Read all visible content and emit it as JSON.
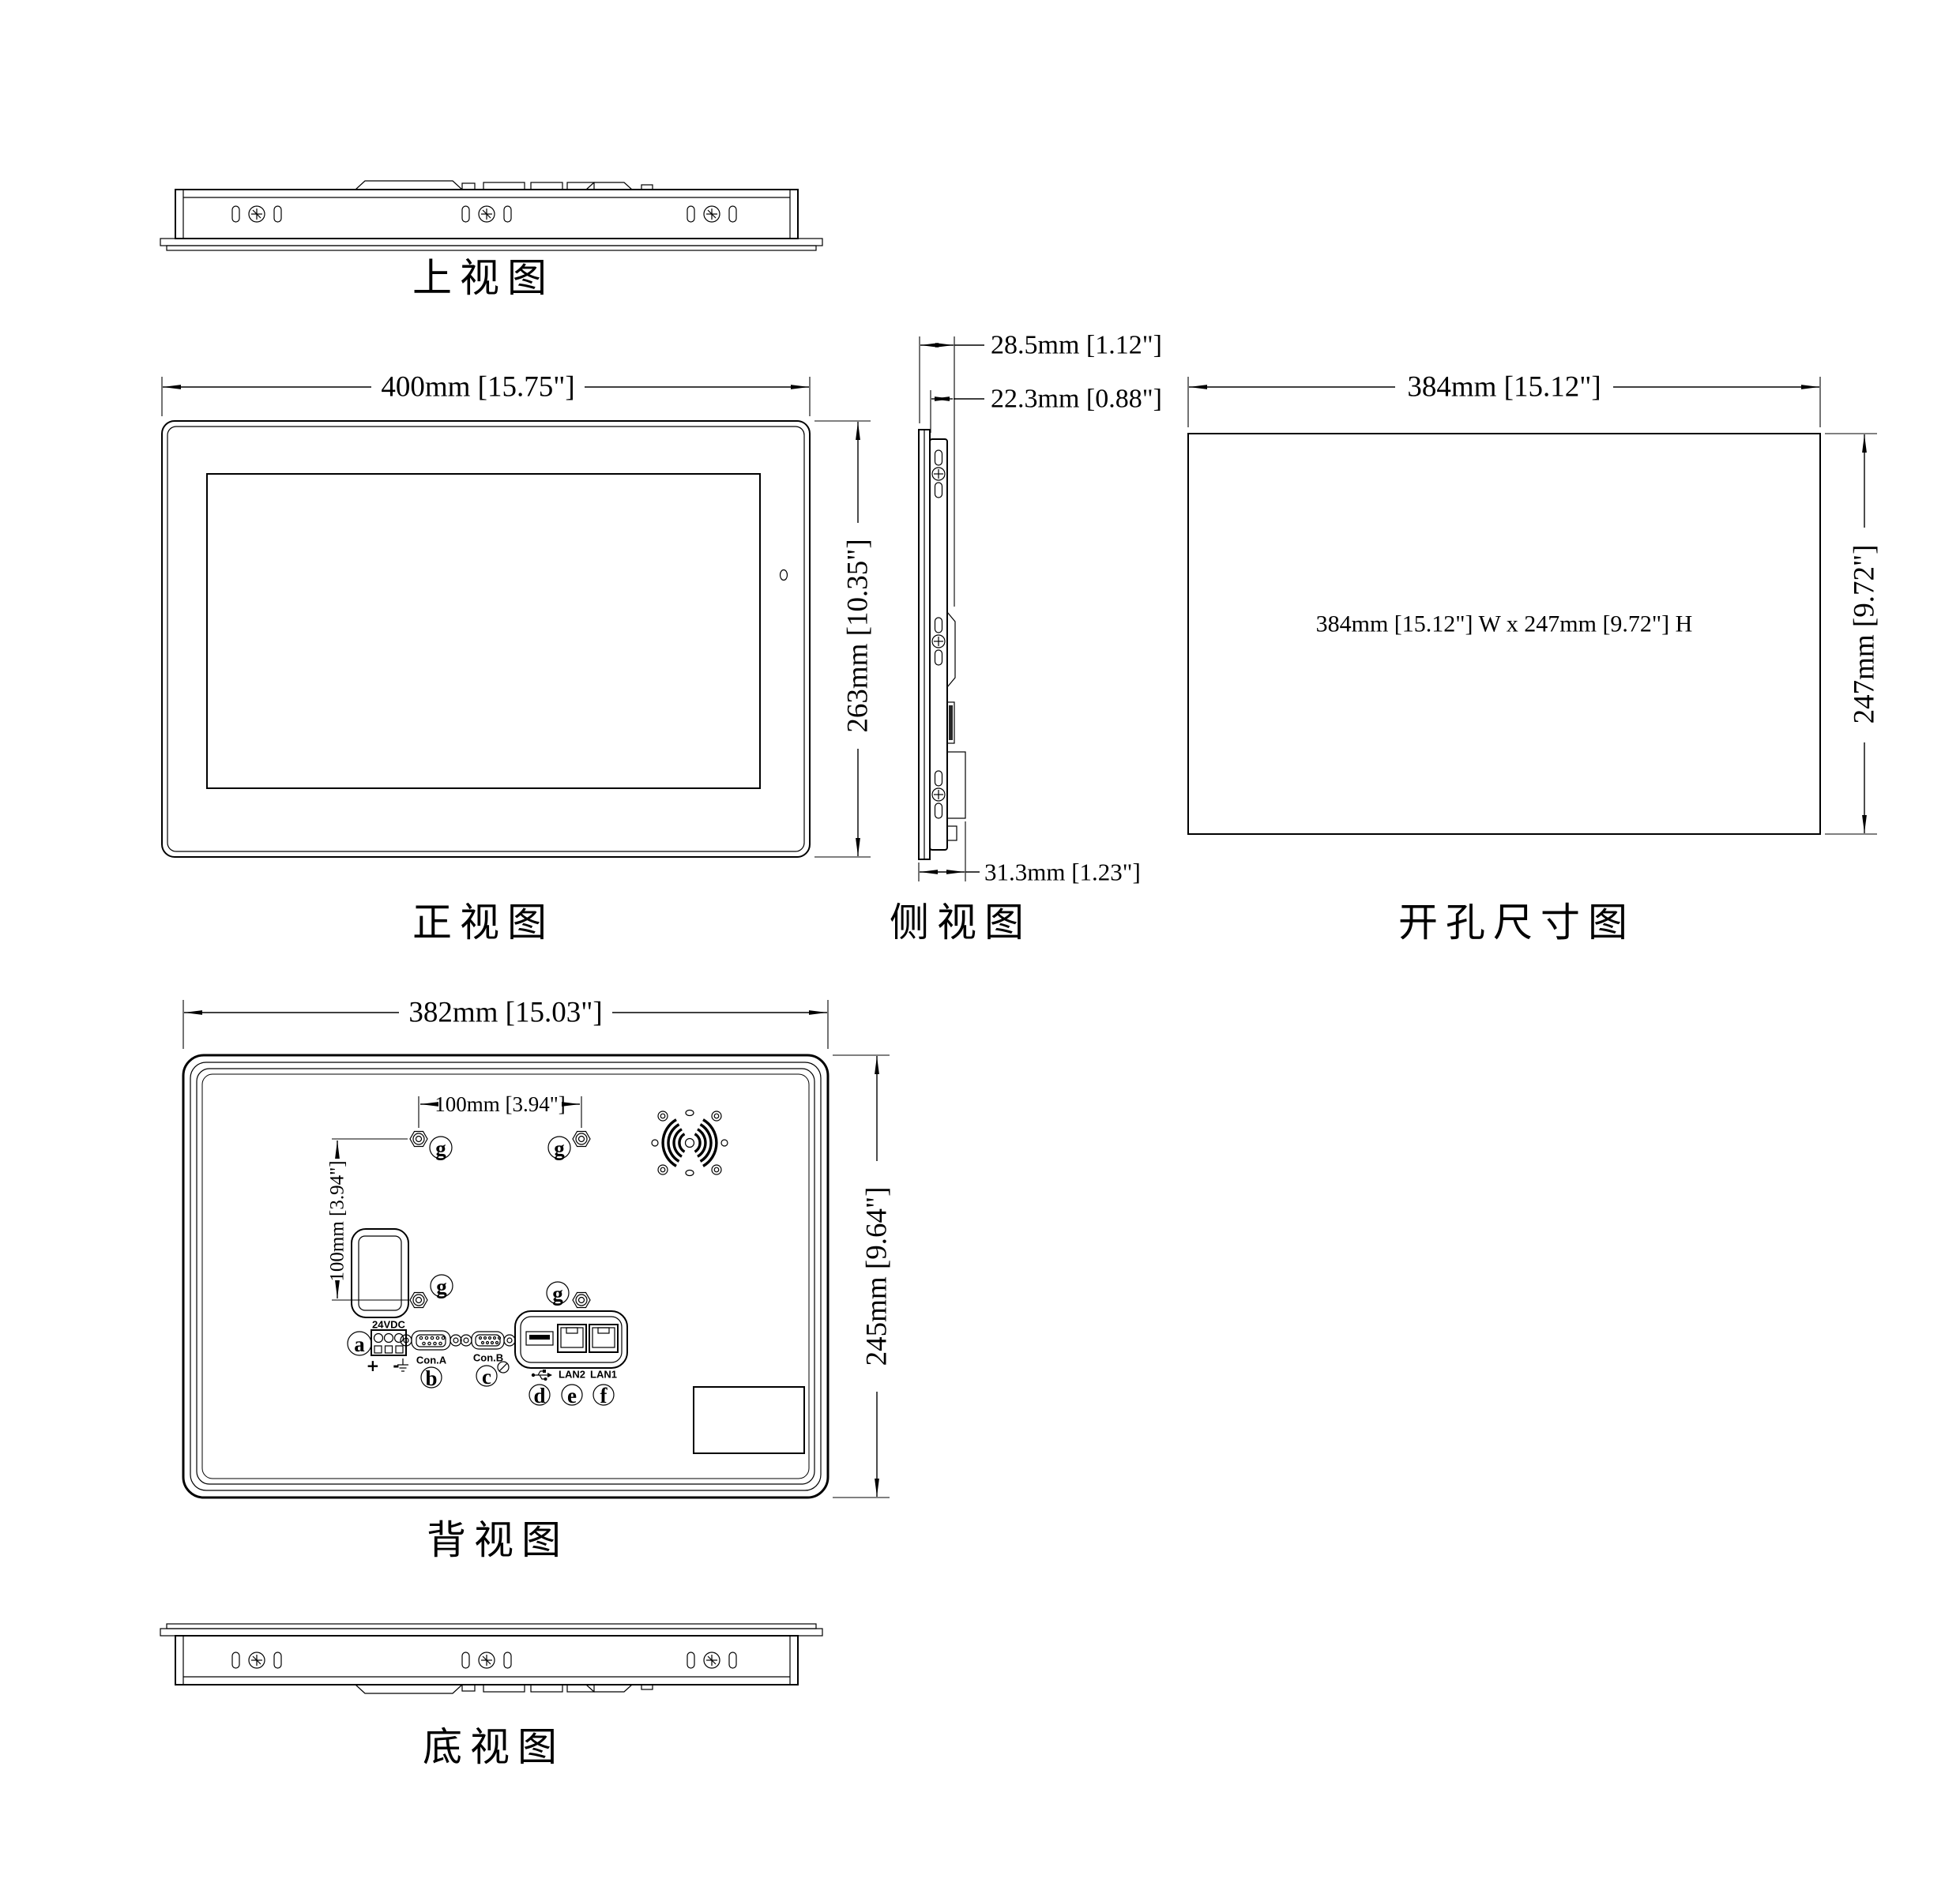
{
  "page": {
    "background": "#ffffff",
    "line_color": "#000000"
  },
  "views": {
    "top": {
      "caption": "上视图"
    },
    "front": {
      "caption": "正视图",
      "width_dim": "400mm [15.75\"]",
      "height_dim": "263mm [10.35\"]"
    },
    "side": {
      "caption": "侧视图",
      "depth_with_connectors_dim": "28.5mm [1.12\"]",
      "body_depth_dim": "22.3mm [0.88\"]",
      "overall_depth_dim": "31.3mm [1.23\"]"
    },
    "cutout": {
      "caption": "开孔尺寸图",
      "width_dim": "384mm [15.12\"]",
      "height_dim": "247mm [9.72\"]",
      "note": "384mm [15.12\"] W x 247mm [9.72\"] H"
    },
    "back": {
      "caption": "背视图",
      "width_dim": "382mm [15.03\"]",
      "height_dim": "245mm [9.64\"]",
      "mount_width_dim": "100mm [3.94\"]",
      "mount_height_dim": "100mm [3.94\"]",
      "ports": {
        "power_label": "24VDC",
        "polarity": "+ -",
        "con_a": "Con.A",
        "con_b": "Con.B",
        "lan2": "LAN2",
        "lan1": "LAN1"
      },
      "callouts": {
        "a": "a",
        "b": "b",
        "c": "c",
        "d": "d",
        "e": "e",
        "f": "f",
        "g": "g"
      }
    },
    "bottom": {
      "caption": "底视图"
    }
  },
  "icons": {
    "usb": "usb-trident-icon",
    "ground": "earth-ground-icon",
    "prohibition": "no-symbol-icon",
    "speaker": "speaker-grille-icon",
    "screw": "screw-head-icon",
    "nut": "hex-nut-icon"
  }
}
